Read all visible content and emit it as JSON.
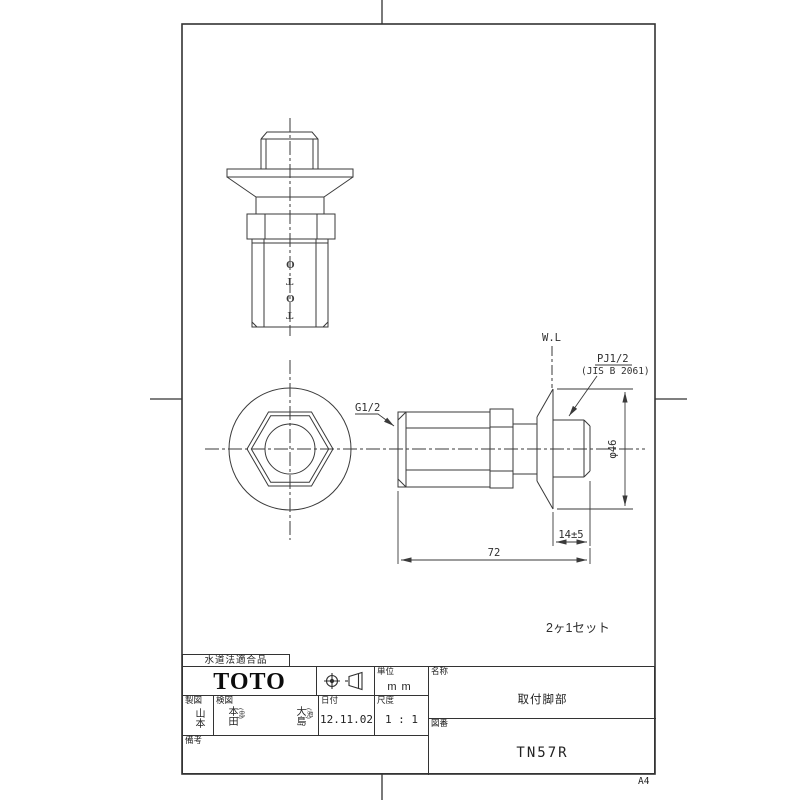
{
  "colors": {
    "line": "#3a3a3a",
    "background": "#ffffff",
    "text": "#222222"
  },
  "sheet": {
    "size_label": "A4",
    "compliance_label": "水道法適合品",
    "note": "2ヶ1セット"
  },
  "views": {
    "front": {
      "engraving": "TOTO"
    },
    "side": {
      "labels": {
        "water_line": "W.L",
        "g_thread": "G1/2",
        "pj_thread": "PJ1/2",
        "pj_standard": "(JIS B 2061)"
      },
      "dimensions": {
        "flange_diameter": "φ46",
        "plug_length": "14±5",
        "total_length": "72"
      }
    }
  },
  "title_block": {
    "logo": "TOTO",
    "unit": {
      "label": "単位",
      "value": "mm"
    },
    "name": {
      "label": "名称",
      "value": "取付脚部"
    },
    "drawing_no": {
      "label": "図番",
      "value": "TN57R"
    },
    "drafting": {
      "label": "製図",
      "value": "山本"
    },
    "checking": {
      "label": "検図",
      "stamps": [
        {
          "name": "本田",
          "sub": "(忠)"
        },
        {
          "name": "大島",
          "sub": "(池)"
        }
      ]
    },
    "date": {
      "label": "日付",
      "value": "12.11.02"
    },
    "scale": {
      "label": "尺度",
      "value": "1 : 1"
    },
    "remarks": {
      "label": "備考",
      "value": ""
    }
  }
}
